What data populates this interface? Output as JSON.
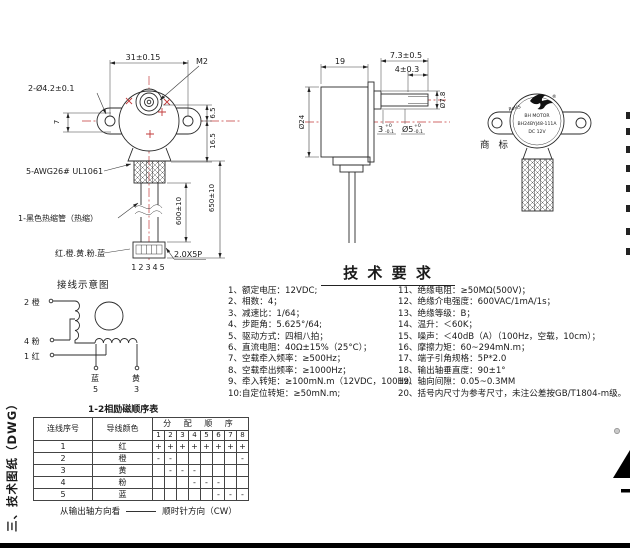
{
  "front_view": {
    "dim_width": "31±0.15",
    "thread_label": "M2",
    "holes_label": "2-Ø4.2±0.1",
    "dim_offset7": "7",
    "dim_6_5": "6.5",
    "dim_16_5": "16.5",
    "wire_label": "5-AWG26#  UL1061",
    "tube_label": "1-黑色热缩管（热缩）",
    "wire_colors_label": "红.橙.黄.粉.蓝",
    "dim_600": "600±10",
    "dim_650": "650±10",
    "pins_label": "12345",
    "pitch_label": "2.0X5P"
  },
  "side_view": {
    "dim_depth": "19",
    "dim_shaft_len": "7.3±0.5",
    "dim_flat_len": "4±0.3",
    "dim_body_dia": "Ø24",
    "dim_boss_dia": "Ø7.8",
    "flat_val": "3",
    "flat_tol_up": "+0",
    "flat_tol_dn": "-0.1",
    "shaft_val": "Ø5",
    "shaft_tol_up": "+0",
    "shaft_tol_dn": "-0.1"
  },
  "trademark": {
    "caption": "商 标",
    "rohs": "RoHS",
    "registered": "®",
    "brand": "BH MOTOR",
    "model": "BH24BYJ48-111A",
    "voltage": "DC 12V"
  },
  "wiring": {
    "title": "接线示意图",
    "terminal_2": "2 橙",
    "terminal_4": "4 粉",
    "terminal_1": "1 红",
    "lead_blue": "蓝",
    "lead_blue_no": "5",
    "lead_yellow": "黄",
    "lead_yellow_no": "3"
  },
  "tech_requirements": {
    "title": "技 术 要 求",
    "left": [
      "1、额定电压：12VDC;",
      "2、相数：4；",
      "3、减速比：1/64；",
      "4、步距角：5.625°/64;",
      "5、驱动方式：四相八拍；",
      "6、直流电阻：40Ω±15%（25°C）；",
      "7、空载牵入频率：≥500Hz；",
      "8、空载牵出频率：≥1000Hz；",
      "9、牵入转矩：≥100mN.m（12VDC，100Hz）",
      "10:自定位转矩：≥50mN.m;"
    ],
    "right": [
      "11、绝缘电阻：≥50MΩ(500V)；",
      "12、绝缘介电强度：600VAC/1mA/1s；",
      "13、绝缘等级：B；",
      "14、温升：＜60K；",
      "15、噪声：＜40dB（A）（100Hz，空载，10cm）；",
      "16、摩擦力矩：60~294mN.m；",
      "17、端子引角规格：5P*2.0",
      "18、输出轴垂直度：90±1°",
      "19、轴向间隙：0.05~0.3MM",
      "20、括号内尺寸为参考尺寸，未注公差按GB/T1804-m级。"
    ]
  },
  "sequence_table": {
    "title": "1-2相励磁顺序表",
    "col_index": "连线序号",
    "col_color": "导线颜色",
    "col_sequence": "分 配 顺 序",
    "seq_numbers": [
      "1",
      "2",
      "3",
      "4",
      "5",
      "6",
      "7",
      "8"
    ],
    "rows": [
      [
        "1",
        "红",
        "+",
        "+",
        "+",
        "+",
        "+",
        "+",
        "+",
        "+"
      ],
      [
        "2",
        "橙",
        "-",
        "-",
        "",
        "",
        "",
        "",
        "",
        "-"
      ],
      [
        "3",
        "黄",
        "",
        "-",
        "-",
        "-",
        "",
        "",
        "",
        ""
      ],
      [
        "4",
        "粉",
        "",
        "",
        "",
        "-",
        "-",
        "-",
        "",
        ""
      ],
      [
        "5",
        "蓝",
        "",
        "",
        "",
        "",
        "",
        "-",
        "-",
        "-"
      ]
    ],
    "footer_left": "从输出轴方向看",
    "footer_right": "顺时针方向（CW）"
  },
  "sidebar_label": "三、技术图纸（DWG）"
}
